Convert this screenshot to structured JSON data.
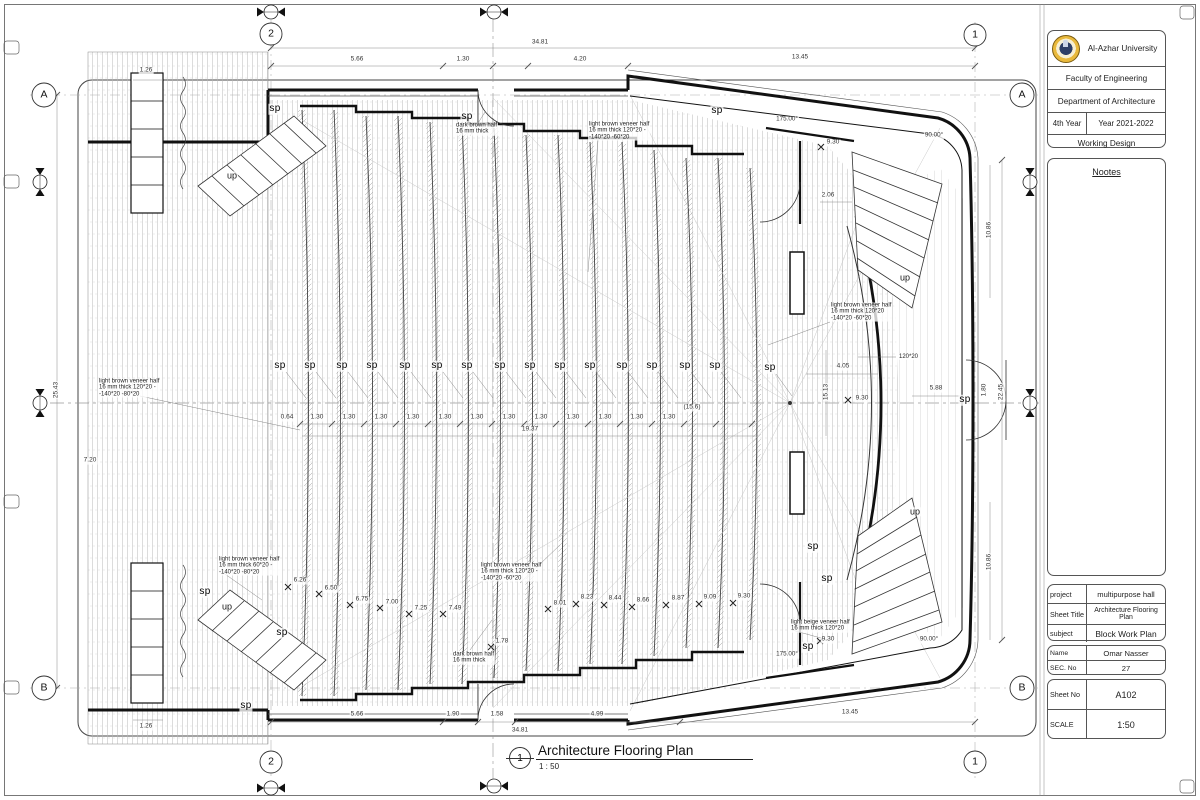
{
  "sheet": {
    "title_block": {
      "university": "Al-Azhar University",
      "faculty": "Faculty of Engineering",
      "department": "Department of Architecture",
      "year_label": "4th Year",
      "academic_year": "Year 2021-2022",
      "design_type": "Working Design",
      "notes_title": "Nootes"
    },
    "project_info": {
      "project_label": "project",
      "project": "multipurpose hall",
      "sheet_title_label": "Sheet Title",
      "sheet_title": "Architecture Flooring Plan",
      "subject_label": "subject",
      "subject": "Block Work Plan",
      "name_label": "Name",
      "name": "Omar Nasser",
      "sec_label": "SEC. No",
      "sec_no": "27",
      "sheet_no_label": "Sheet No",
      "sheet_no": "A102",
      "scale_label": "SCALE",
      "scale": "1:50"
    },
    "view_title": {
      "number": "1",
      "title": "Architecture Flooring Plan",
      "scale": "1 : 50"
    }
  },
  "colors": {
    "logo_gold": "#e9b93c",
    "line_dark": "#1a1a1a",
    "hatch_gray": "#b9b9b9"
  },
  "plan": {
    "labels": [
      {
        "t": "2",
        "x": 271,
        "y": 34,
        "c": "grid"
      },
      {
        "t": "1",
        "x": 975,
        "y": 35,
        "c": "grid"
      },
      {
        "t": "2",
        "x": 271,
        "y": 762,
        "c": "grid"
      },
      {
        "t": "1",
        "x": 975,
        "y": 762,
        "c": "grid"
      },
      {
        "t": "A",
        "x": 44,
        "y": 95,
        "c": "grid"
      },
      {
        "t": "B",
        "x": 44,
        "y": 688,
        "c": "grid"
      },
      {
        "t": "A",
        "x": 1022,
        "y": 95,
        "c": "grid"
      },
      {
        "t": "B",
        "x": 1022,
        "y": 688,
        "c": "grid"
      },
      {
        "t": "34.81",
        "x": 540,
        "y": 43,
        "c": "dim"
      },
      {
        "t": "5.66",
        "x": 357,
        "y": 60,
        "c": "dim"
      },
      {
        "t": "1.30",
        "x": 463,
        "y": 60,
        "c": "dim"
      },
      {
        "t": "4.20",
        "x": 580,
        "y": 60,
        "c": "dim"
      },
      {
        "t": "13.45",
        "x": 800,
        "y": 58,
        "c": "dim"
      },
      {
        "t": "34.81",
        "x": 520,
        "y": 731,
        "c": "dim"
      },
      {
        "t": "5.66",
        "x": 357,
        "y": 715,
        "c": "dim"
      },
      {
        "t": "1.90",
        "x": 453,
        "y": 715,
        "c": "dim"
      },
      {
        "t": "1.58",
        "x": 497,
        "y": 715,
        "c": "dim"
      },
      {
        "t": "4.99",
        "x": 597,
        "y": 715,
        "c": "dim"
      },
      {
        "t": "13.45",
        "x": 850,
        "y": 713,
        "c": "dim"
      },
      {
        "t": "25.43",
        "x": 57,
        "y": 390,
        "c": "dimr"
      },
      {
        "t": "22.45",
        "x": 1002,
        "y": 392,
        "c": "dimr"
      },
      {
        "t": "10.86",
        "x": 990,
        "y": 230,
        "c": "dimr"
      },
      {
        "t": "10.86",
        "x": 990,
        "y": 562,
        "c": "dimr"
      },
      {
        "t": "1.80",
        "x": 985,
        "y": 390,
        "c": "dimr"
      },
      {
        "t": "4.05",
        "x": 843,
        "y": 367,
        "c": "dim"
      },
      {
        "t": "15.13",
        "x": 827,
        "y": 392,
        "c": "dimr"
      },
      {
        "t": "9.30",
        "x": 862,
        "y": 399,
        "c": "dim"
      },
      {
        "t": "5.88",
        "x": 936,
        "y": 389,
        "c": "dim"
      },
      {
        "t": "(15.6)",
        "x": 692,
        "y": 408,
        "c": "dim"
      },
      {
        "t": "19.37",
        "x": 530,
        "y": 430,
        "c": "dim"
      },
      {
        "t": "0.64",
        "x": 287,
        "y": 418,
        "c": "dim"
      },
      {
        "t": "1.30",
        "x": 317,
        "y": 418,
        "c": "dim"
      },
      {
        "t": "1.30",
        "x": 349,
        "y": 418,
        "c": "dim"
      },
      {
        "t": "1.30",
        "x": 381,
        "y": 418,
        "c": "dim"
      },
      {
        "t": "1.30",
        "x": 413,
        "y": 418,
        "c": "dim"
      },
      {
        "t": "1.30",
        "x": 445,
        "y": 418,
        "c": "dim"
      },
      {
        "t": "1.30",
        "x": 477,
        "y": 418,
        "c": "dim"
      },
      {
        "t": "1.30",
        "x": 509,
        "y": 418,
        "c": "dim"
      },
      {
        "t": "1.30",
        "x": 541,
        "y": 418,
        "c": "dim"
      },
      {
        "t": "1.30",
        "x": 573,
        "y": 418,
        "c": "dim"
      },
      {
        "t": "1.30",
        "x": 605,
        "y": 418,
        "c": "dim"
      },
      {
        "t": "1.30",
        "x": 637,
        "y": 418,
        "c": "dim"
      },
      {
        "t": "1.30",
        "x": 669,
        "y": 418,
        "c": "dim"
      },
      {
        "t": "9.30",
        "x": 833,
        "y": 143,
        "c": "dim"
      },
      {
        "t": "9.30",
        "x": 828,
        "y": 640,
        "c": "dim"
      },
      {
        "t": "2.06",
        "x": 828,
        "y": 196,
        "c": "dim"
      },
      {
        "t": "1.26",
        "x": 146,
        "y": 71,
        "c": "dim"
      },
      {
        "t": "1.26",
        "x": 146,
        "y": 727,
        "c": "dim"
      },
      {
        "t": "7.20",
        "x": 90,
        "y": 461,
        "c": "dim"
      },
      {
        "t": "6.26",
        "x": 300,
        "y": 581,
        "c": "dim"
      },
      {
        "t": "6.50",
        "x": 331,
        "y": 589,
        "c": "dim"
      },
      {
        "t": "6.75",
        "x": 362,
        "y": 600,
        "c": "dim"
      },
      {
        "t": "7.00",
        "x": 392,
        "y": 603,
        "c": "dim"
      },
      {
        "t": "7.25",
        "x": 421,
        "y": 609,
        "c": "dim"
      },
      {
        "t": "7.49",
        "x": 455,
        "y": 609,
        "c": "dim"
      },
      {
        "t": "1.78",
        "x": 502,
        "y": 642,
        "c": "dim"
      },
      {
        "t": "8.01",
        "x": 560,
        "y": 604,
        "c": "dim"
      },
      {
        "t": "8.23",
        "x": 587,
        "y": 598,
        "c": "dim"
      },
      {
        "t": "8.44",
        "x": 615,
        "y": 599,
        "c": "dim"
      },
      {
        "t": "8.66",
        "x": 643,
        "y": 601,
        "c": "dim"
      },
      {
        "t": "8.87",
        "x": 678,
        "y": 599,
        "c": "dim"
      },
      {
        "t": "9.09",
        "x": 710,
        "y": 598,
        "c": "dim"
      },
      {
        "t": "9.30",
        "x": 744,
        "y": 597,
        "c": "dim"
      },
      {
        "t": "175.00°",
        "x": 787,
        "y": 120,
        "c": "angle"
      },
      {
        "t": "175.00°",
        "x": 787,
        "y": 655,
        "c": "angle"
      },
      {
        "t": "90.00°",
        "x": 934,
        "y": 136,
        "c": "angle"
      },
      {
        "t": "90.00°",
        "x": 929,
        "y": 640,
        "c": "angle"
      },
      {
        "t": "sp",
        "x": 280,
        "y": 366,
        "c": "sp"
      },
      {
        "t": "sp",
        "x": 310,
        "y": 366,
        "c": "sp"
      },
      {
        "t": "sp",
        "x": 342,
        "y": 366,
        "c": "sp"
      },
      {
        "t": "sp",
        "x": 372,
        "y": 366,
        "c": "sp"
      },
      {
        "t": "sp",
        "x": 405,
        "y": 366,
        "c": "sp"
      },
      {
        "t": "sp",
        "x": 437,
        "y": 366,
        "c": "sp"
      },
      {
        "t": "sp",
        "x": 467,
        "y": 366,
        "c": "sp"
      },
      {
        "t": "sp",
        "x": 500,
        "y": 366,
        "c": "sp"
      },
      {
        "t": "sp",
        "x": 530,
        "y": 366,
        "c": "sp"
      },
      {
        "t": "sp",
        "x": 560,
        "y": 366,
        "c": "sp"
      },
      {
        "t": "sp",
        "x": 590,
        "y": 366,
        "c": "sp"
      },
      {
        "t": "sp",
        "x": 622,
        "y": 366,
        "c": "sp"
      },
      {
        "t": "sp",
        "x": 652,
        "y": 366,
        "c": "sp"
      },
      {
        "t": "sp",
        "x": 685,
        "y": 366,
        "c": "sp"
      },
      {
        "t": "sp",
        "x": 715,
        "y": 366,
        "c": "sp"
      },
      {
        "t": "sp",
        "x": 770,
        "y": 368,
        "c": "sp"
      },
      {
        "t": "sp",
        "x": 965,
        "y": 400,
        "c": "sp"
      },
      {
        "t": "sp",
        "x": 467,
        "y": 117,
        "c": "sp"
      },
      {
        "t": "sp",
        "x": 717,
        "y": 111,
        "c": "sp"
      },
      {
        "t": "sp",
        "x": 275,
        "y": 109,
        "c": "sp"
      },
      {
        "t": "sp",
        "x": 205,
        "y": 592,
        "c": "sp"
      },
      {
        "t": "sp",
        "x": 282,
        "y": 633,
        "c": "sp"
      },
      {
        "t": "sp",
        "x": 246,
        "y": 706,
        "c": "sp"
      },
      {
        "t": "sp",
        "x": 813,
        "y": 547,
        "c": "sp"
      },
      {
        "t": "sp",
        "x": 827,
        "y": 579,
        "c": "sp"
      },
      {
        "t": "sp",
        "x": 808,
        "y": 647,
        "c": "sp"
      },
      {
        "t": "up",
        "x": 232,
        "y": 176,
        "c": "up"
      },
      {
        "t": "up",
        "x": 227,
        "y": 607,
        "c": "up"
      },
      {
        "t": "up",
        "x": 905,
        "y": 278,
        "c": "up"
      },
      {
        "t": "up",
        "x": 915,
        "y": 512,
        "c": "up"
      },
      {
        "t": "light brown veneer half\n16 mm thick 120*20 -\n-140*20 -80*20",
        "x": 98,
        "y": 388,
        "c": "note"
      },
      {
        "t": "light brown veneer half\n16 mm thick 60*20 -\n-140*20 -80*20",
        "x": 218,
        "y": 566,
        "c": "note"
      },
      {
        "t": "light brown veneer half\n16 mm thick 120*20 -\n-140*20 -60*20",
        "x": 480,
        "y": 572,
        "c": "note"
      },
      {
        "t": "dark brown half\n16 mm thick",
        "x": 452,
        "y": 658,
        "c": "note"
      },
      {
        "t": "light beige veneer half\n16 mm thick 120*20",
        "x": 790,
        "y": 626,
        "c": "note"
      },
      {
        "t": "dark brown half\n16 mm thick",
        "x": 455,
        "y": 129,
        "c": "note"
      },
      {
        "t": "light brown veneer half\n16 mm thick 120*20 -\n-140*20 -60*20",
        "x": 588,
        "y": 131,
        "c": "note"
      },
      {
        "t": "light brown veneer half\n16 mm thick 120*20\n-140*20 -60*20",
        "x": 830,
        "y": 312,
        "c": "note"
      },
      {
        "t": "120*20",
        "x": 898,
        "y": 357,
        "c": "note"
      }
    ]
  }
}
